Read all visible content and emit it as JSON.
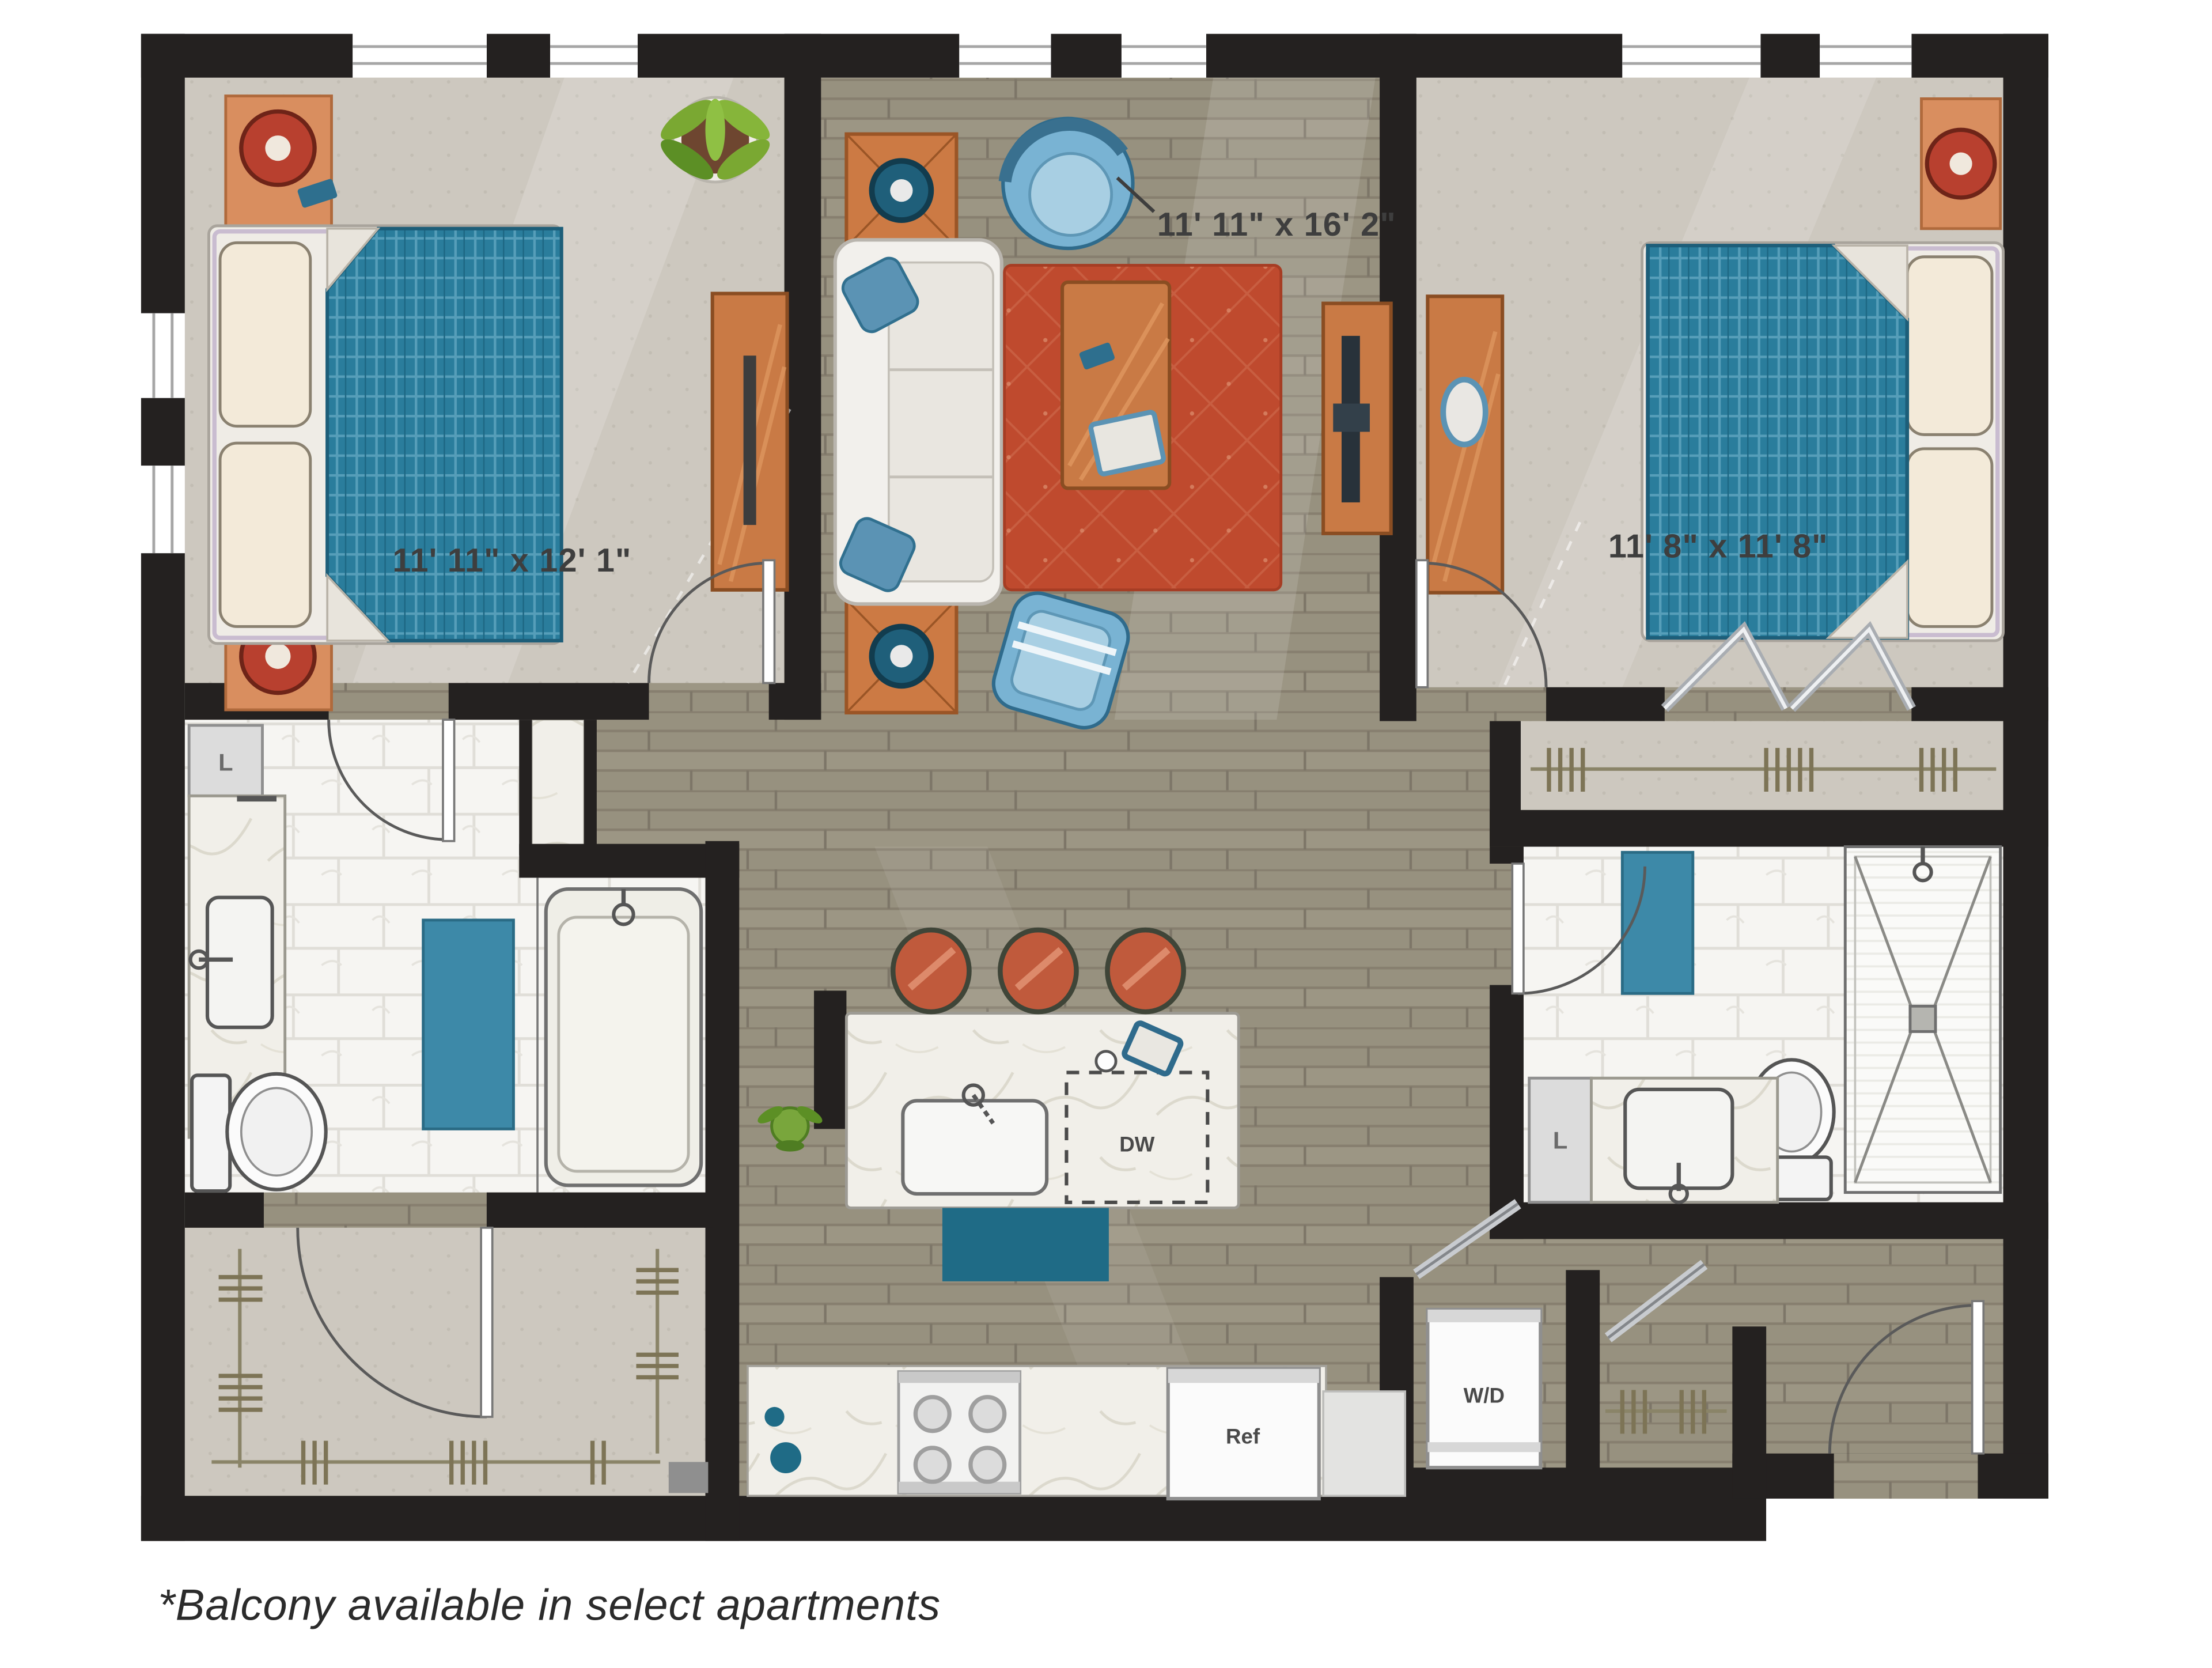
{
  "floorplan": {
    "footnote": "*Balcony available in select apartments",
    "rooms": {
      "living_room": {
        "dimensions": "11' 11\" x 16' 2\""
      },
      "bedroom_1": {
        "dimensions": "11' 11\" x 12' 1\""
      },
      "bedroom_2": {
        "dimensions": "11' 8\" x 11' 8\""
      }
    },
    "appliances": {
      "dishwasher": "DW",
      "refrigerator": "Ref",
      "washer_dryer": "W/D"
    },
    "closets": {
      "linen_bath_1": "L",
      "linen_bath_2": "L"
    },
    "colors": {
      "wall": "#242120",
      "wood_floor": "#97917f",
      "carpet": "#cdc8bf",
      "bathroom_tile": "#f6f5f2",
      "marble_counter": "#f1efe9",
      "bed_blanket_teal": "#2a7d9c",
      "accent_mat_teal": "#1f6b86",
      "towel_blue": "#3d89a8",
      "rug_red": "#bf4a2e",
      "furniture_wood_orange": "#c97a45",
      "stool_red": "#c05a3c",
      "lamp_red": "#b8402f",
      "chair_blue": "#79b3d3"
    }
  }
}
